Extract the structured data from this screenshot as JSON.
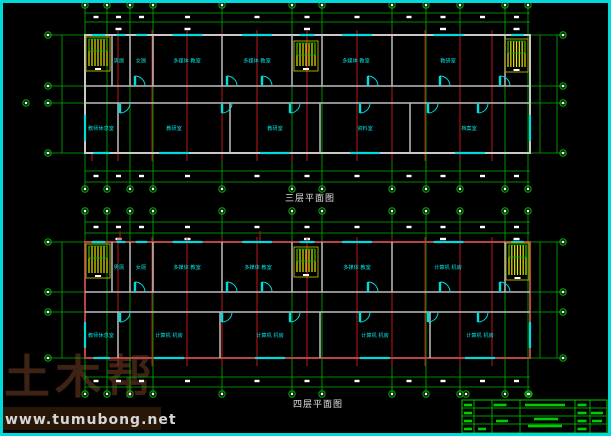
{
  "watermark": {
    "brand": "土木帮",
    "url": "www.tumubong.net"
  },
  "colors": {
    "bg": "#000000",
    "border": "#00d9d9",
    "grid": "#00b400",
    "red": "#c01818",
    "wall": "#bdbdbd",
    "cyan": "#00dcdc",
    "yellow": "#e8e800",
    "stair_frame": "#a8a800",
    "label": "#00e2e2",
    "white": "#ffffff"
  },
  "plans": [
    {
      "name": "third-floor-plan",
      "title": "三层平面图",
      "bx": 85,
      "bx2": 530,
      "by": 35,
      "by2": 153,
      "cy1": 86,
      "cy2": 103,
      "grid_y1": 5,
      "grid_y2": 189,
      "cols": [
        85,
        107,
        130,
        153,
        222,
        292,
        322,
        392,
        426,
        460,
        505,
        528
      ],
      "side_cols": [
        62,
        540,
        557
      ],
      "dim_lines": [
        13,
        22,
        171,
        182
      ],
      "blob_rows_full": [
        17,
        176
      ],
      "blob_rows_sparse": [
        29
      ],
      "bubble_rows": [
        5,
        189
      ],
      "side_bubble_x": [
        48,
        563
      ],
      "extra_bubbles": [
        [
          26,
          103
        ]
      ],
      "red_x": [
        118,
        152,
        187,
        222,
        257,
        307,
        357,
        392,
        425,
        460,
        492
      ],
      "red_y": [
        30,
        161
      ],
      "red_stubs": [
        [
          92,
          153,
          161
        ],
        [
          292,
          153,
          162
        ]
      ],
      "parts_upper": [
        112,
        130,
        153,
        222,
        292,
        322,
        392,
        505
      ],
      "parts_lower": [
        118,
        230,
        320,
        410
      ],
      "stairs": [
        [
          86,
          37,
          24,
          34
        ],
        [
          294,
          41,
          24,
          30
        ],
        [
          505,
          39,
          23,
          33
        ]
      ],
      "arcs_upper": [
        135,
        227,
        262,
        368,
        440,
        500
      ],
      "arcs_lower": [
        120,
        222,
        290,
        360,
        428,
        478
      ],
      "rooms_upper": [
        [
          "男厕",
          119
        ],
        [
          "女厕",
          141
        ],
        [
          "多媒体 教室",
          187
        ],
        [
          "多媒体 教室",
          257
        ],
        [
          "多媒体 教室",
          356
        ],
        [
          "教研室",
          448
        ]
      ],
      "rooms_lower": [
        [
          "教师休息室",
          101
        ],
        [
          "教研室",
          174
        ],
        [
          "教研室",
          275
        ],
        [
          "资料室",
          365
        ],
        [
          "档案室",
          469
        ]
      ],
      "wall_color": "#c9c9c9"
    },
    {
      "name": "fourth-floor-plan",
      "title": "四层平面图",
      "bx": 85,
      "bx2": 530,
      "by": 242,
      "by2": 358,
      "cy1": 292,
      "cy2": 312,
      "grid_y1": 211,
      "grid_y2": 394,
      "cols": [
        85,
        107,
        130,
        153,
        222,
        292,
        322,
        392,
        426,
        460,
        505,
        528
      ],
      "side_cols": [
        62,
        540,
        557
      ],
      "dim_lines": [
        222,
        233,
        377,
        387
      ],
      "blob_rows_full": [
        227,
        381
      ],
      "blob_rows_sparse": [
        239
      ],
      "bubble_rows": [
        211,
        394
      ],
      "side_bubble_x": [
        48,
        563
      ],
      "extra_bubbles": [],
      "red_x": [
        118,
        152,
        187,
        222,
        257,
        307,
        357,
        392,
        425,
        460,
        492
      ],
      "red_y": [
        237,
        366
      ],
      "red_stubs": [
        [
          120,
          231,
          241
        ],
        [
          260,
          231,
          241
        ]
      ],
      "parts_upper": [
        112,
        130,
        153,
        222,
        292,
        322,
        392,
        505
      ],
      "parts_lower": [
        118,
        220,
        320,
        430
      ],
      "stairs": [
        [
          86,
          244,
          24,
          34
        ],
        [
          294,
          247,
          24,
          30
        ],
        [
          506,
          243,
          23,
          37
        ]
      ],
      "arcs_upper": [
        135,
        227,
        262,
        368,
        440,
        500
      ],
      "arcs_lower": [
        120,
        222,
        290,
        360,
        428,
        478
      ],
      "rooms_upper": [
        [
          "男厕",
          119
        ],
        [
          "女厕",
          141
        ],
        [
          "多媒体 教室",
          187
        ],
        [
          "多媒体 教室",
          258
        ],
        [
          "多媒体 教室",
          357
        ],
        [
          "计算机 机房",
          448
        ]
      ],
      "rooms_lower": [
        [
          "教师休息室",
          101
        ],
        [
          "计算机 机房",
          169
        ],
        [
          "计算机 机房",
          270
        ],
        [
          "计算机 机房",
          375
        ],
        [
          "计算机 机房",
          480
        ]
      ],
      "wall_color": "#b64545"
    }
  ],
  "title_block": {
    "x": 462,
    "y": 400,
    "x2": 607,
    "y2": 433,
    "vlines": [
      474,
      492,
      520,
      575,
      590
    ],
    "hlines": [
      408,
      416,
      424
    ],
    "blobs": [
      [
        468,
        405,
        8
      ],
      [
        468,
        413,
        8
      ],
      [
        468,
        421,
        8
      ],
      [
        468,
        429,
        8
      ],
      [
        482,
        429,
        8
      ],
      [
        500,
        405,
        13
      ],
      [
        502,
        421,
        12
      ],
      [
        545,
        405,
        40
      ],
      [
        546,
        419,
        24
      ],
      [
        545,
        426,
        34
      ],
      [
        582,
        405,
        9
      ],
      [
        582,
        413,
        9
      ],
      [
        582,
        421,
        9
      ],
      [
        582,
        429,
        9
      ],
      [
        597,
        413,
        12
      ],
      [
        597,
        421,
        10
      ]
    ],
    "dots": [
      [
        466,
        394
      ],
      [
        529,
        394
      ]
    ],
    "color": "#00cc00"
  }
}
